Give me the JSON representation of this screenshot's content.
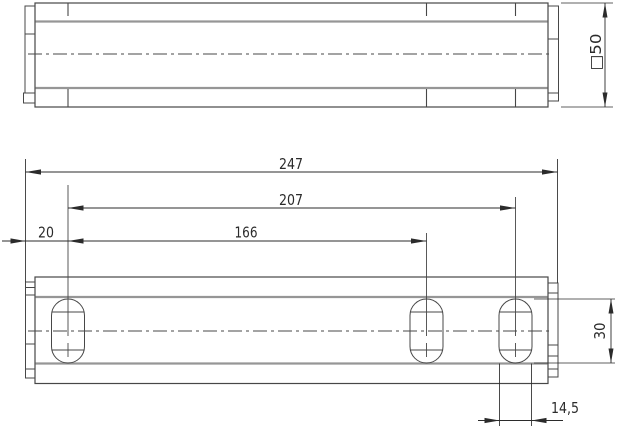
{
  "drawing": {
    "dims": {
      "overall_length": "247",
      "outer_slot_span": "207",
      "inner_slot_span": "166",
      "first_slot_offset": "20",
      "profile_size": "□50",
      "slot_length": "30",
      "slot_width": "14,5"
    },
    "colors": {
      "outline": "#474747",
      "inner_edge": "#969696",
      "dimension": "#2b2b2b",
      "background": "#ffffff"
    }
  }
}
